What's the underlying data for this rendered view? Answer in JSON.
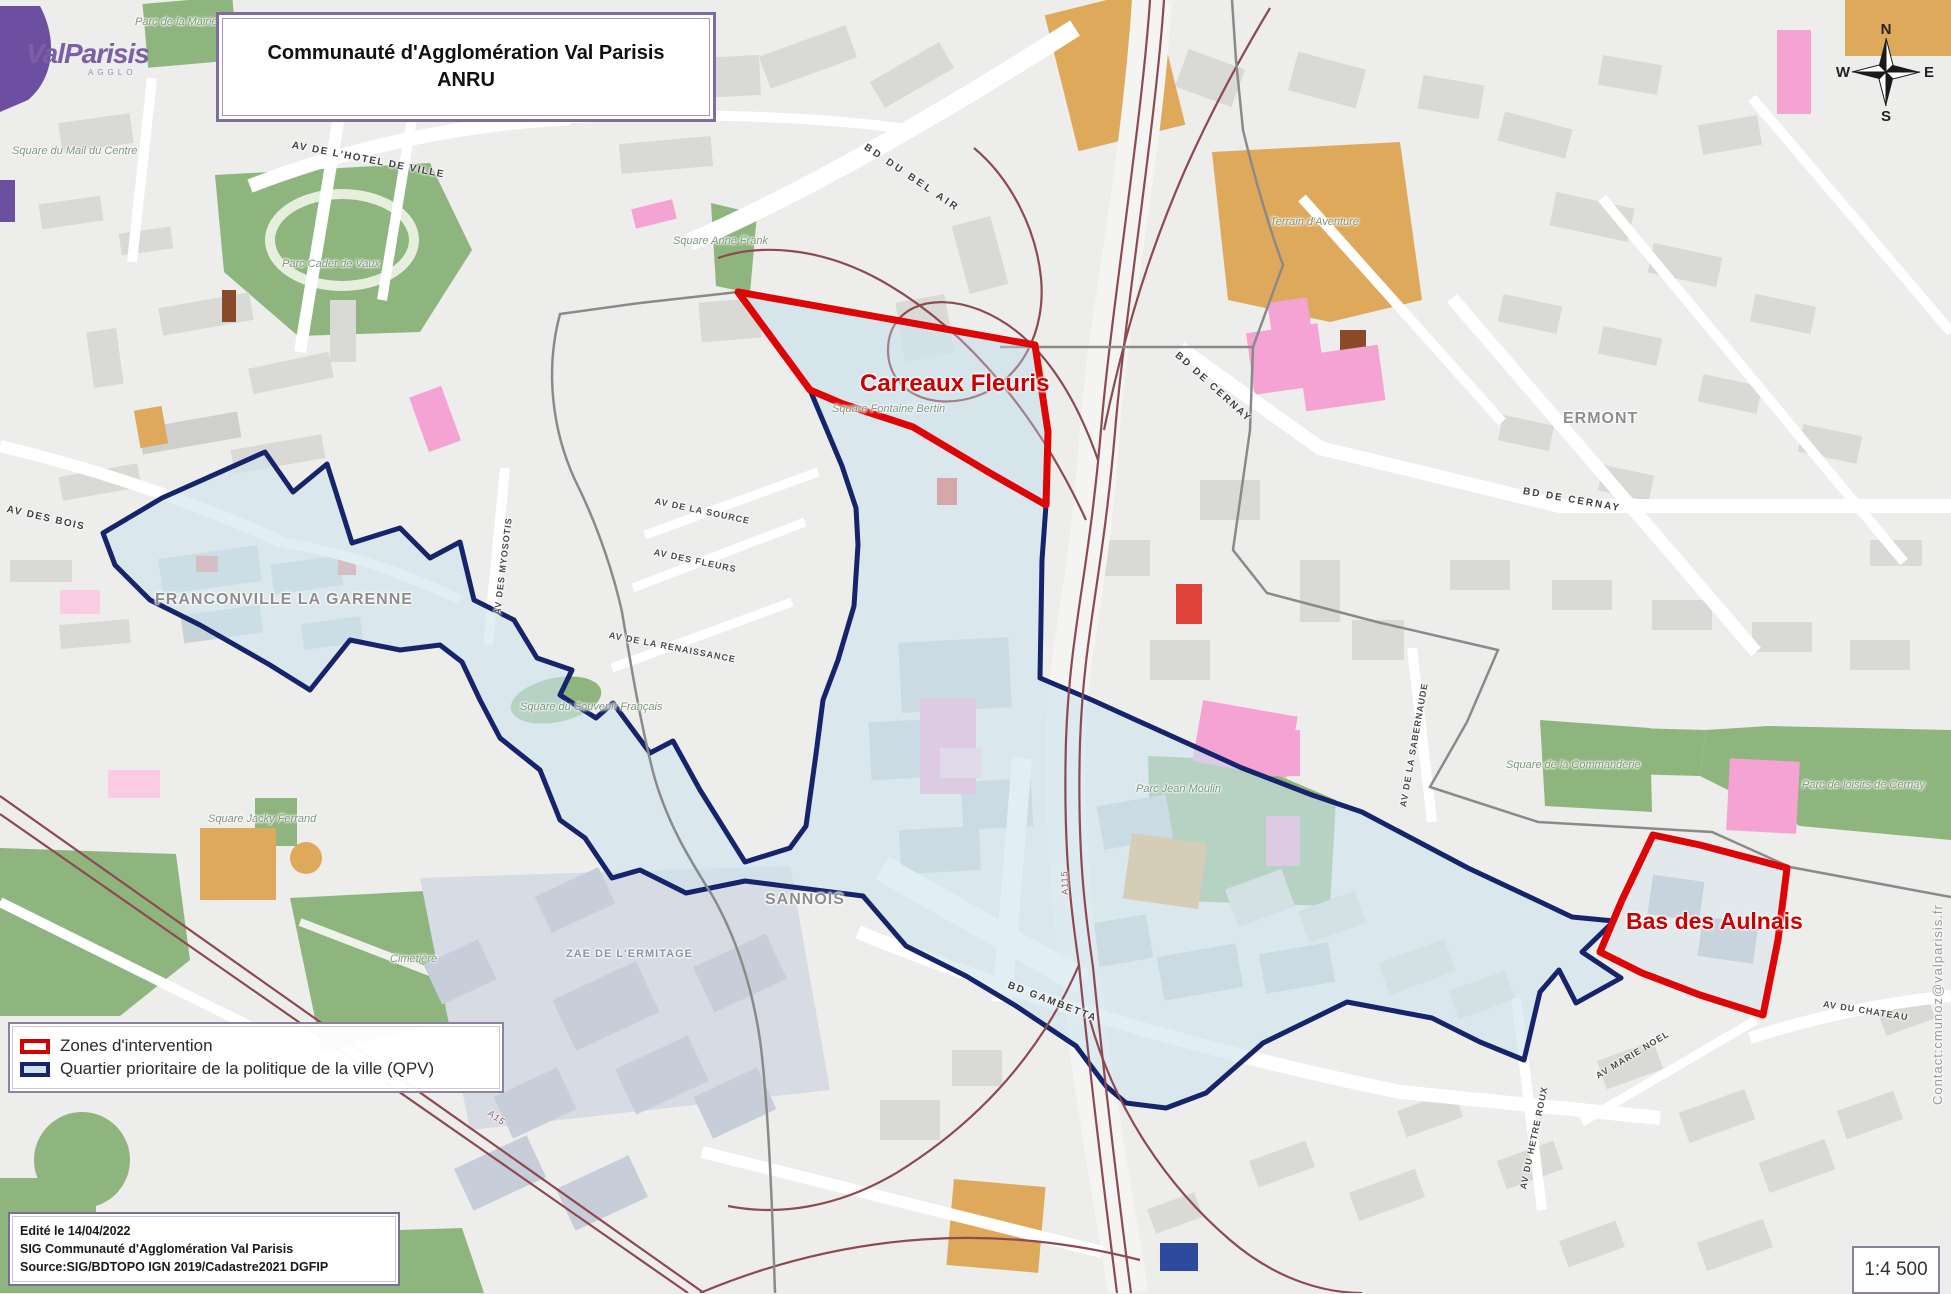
{
  "title": {
    "line1": "Communauté d'Agglomération Val Parisis",
    "line2": "ANRU"
  },
  "logo": {
    "name": "ValParisis",
    "sub": "AGGLO"
  },
  "compass": {
    "n": "N",
    "s": "S",
    "e": "E",
    "w": "W"
  },
  "zones": {
    "carreaux_fleuris": "Carreaux Fleuris",
    "bas_des_aulnais": "Bas des Aulnais"
  },
  "cities": {
    "franconville": "FRANCONVILLE LA GARENNE",
    "sannois": "SANNOIS",
    "ermont": "ERMONT"
  },
  "streets": {
    "av_hotel_de_ville": "AV DE L'HOTEL DE VILLE",
    "bd_du_bel_air": "BD DU BEL AIR",
    "bd_de_cernay_1": "BD DE CERNAY",
    "bd_de_cernay_2": "BD DE CERNAY",
    "av_des_bois": "AV DES BOIS",
    "av_des_myosotis": "AV DES MYOSOTIS",
    "av_de_la_source": "AV DE LA SOURCE",
    "av_des_fleurs": "AV DES FLEURS",
    "av_de_la_renaissance": "AV DE LA RENAISSANCE",
    "bd_gambetta": "BD GAMBETTA",
    "av_de_la_sabernaude": "AV DE LA SABERNAUDE",
    "av_du_hetre_roux": "AV DU HETRE ROUX",
    "av_marie_noel": "AV MARIE NOEL",
    "av_du_chateau": "AV DU CHATEAU",
    "a115": "A115",
    "a15": "A15"
  },
  "places": {
    "parc_de_la_mairie": "Parc de la Mairie",
    "square_du_mail": "Square du Mail du Centre",
    "parc_cadet_de_vaux": "Parc Cadet de Vaux",
    "square_anne_frank": "Square Anne Frank",
    "square_fontaine_bertin": "Square Fontaine Bertin",
    "terrain_aventure": "Terrain d'Aventure",
    "square_du_souvenir": "Square du Souvenir Français",
    "square_jacky_ferrand": "Square Jacky Ferrand",
    "cimetiere": "Cimetière",
    "zae_ermitage": "ZAE DE L'ERMITAGE",
    "parc_jean_moulin": "Parc Jean Moulin",
    "square_commanderie": "Square de la Commanderie",
    "parc_loisirs_cernay": "Parc de loisirs de Cernay"
  },
  "legend": {
    "items": [
      {
        "label": "Zones d'intervention",
        "color": "#d40000"
      },
      {
        "label": "Quartier prioritaire de la politique de la ville (QPV)",
        "color": "#16246b"
      }
    ]
  },
  "info_box": {
    "line1": "Edité le 14/04/2022",
    "line2": "SIG Communauté d'Agglomération Val Parisis",
    "line3": "Source:SIG/BDTOPO IGN 2019/Cadastre2021 DGFIP"
  },
  "scale": {
    "value": "1:4 500"
  },
  "contact": {
    "text": "Contact:cmunoz@valparisis.fr"
  },
  "colors": {
    "zone_red": "#d40000",
    "qpv_navy": "#16246b",
    "qpv_fill": "#cfe3ee",
    "park_green": "#8fb57e",
    "building_tan": "#dfa95c",
    "building_pink": "#f4a3d2",
    "railway_maroon": "#8d4a52",
    "brand_purple": "#7b5fa7"
  }
}
